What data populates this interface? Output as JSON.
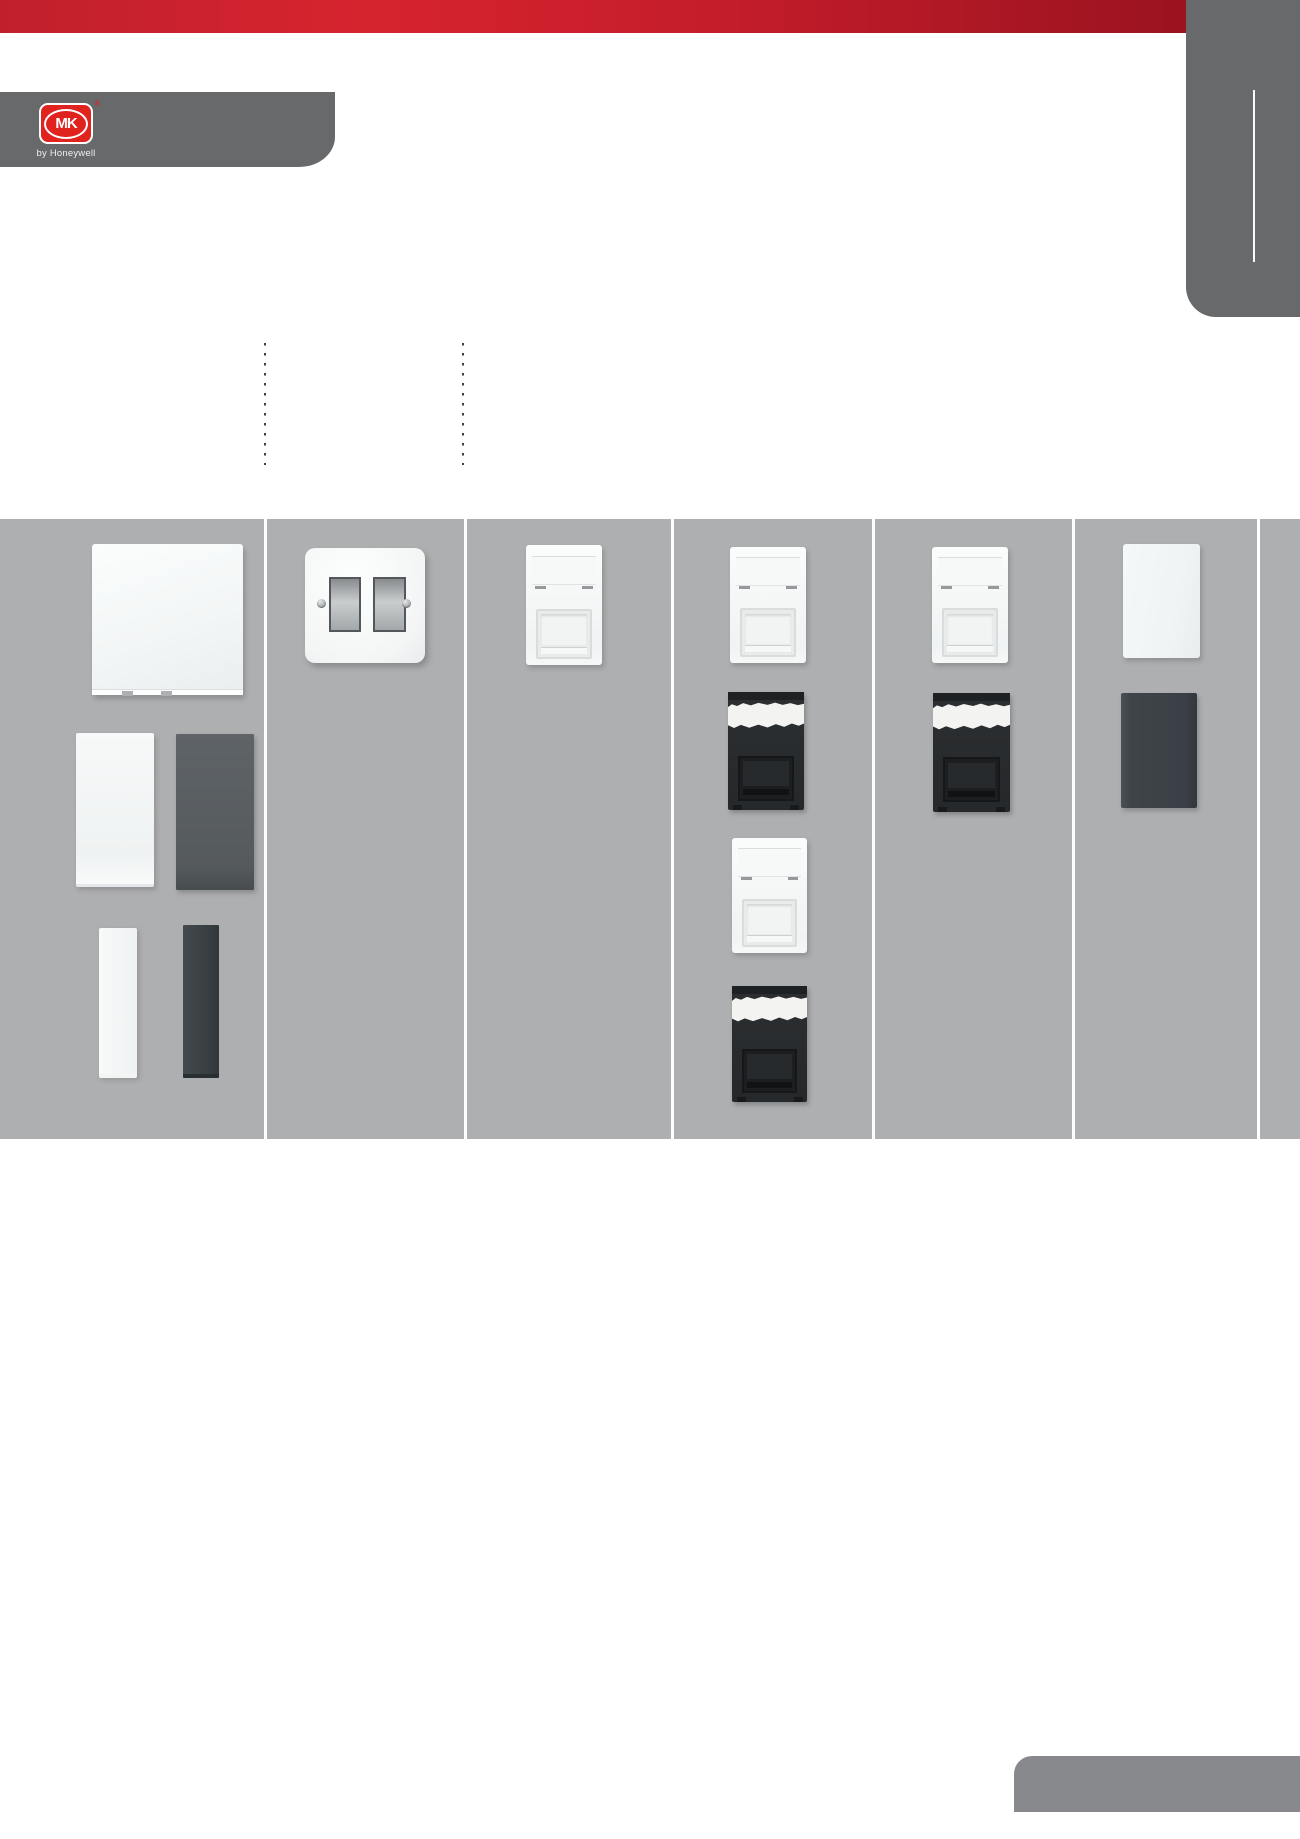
{
  "brand": {
    "logo_text": "MK",
    "registered": "®",
    "logo_sub": "by Honeywell"
  },
  "colors": {
    "banner_left": "#c0202c",
    "banner_mid": "#d6242f",
    "banner_mid2": "#c51d2a",
    "banner_right": "#9c1320",
    "brand_bar": "#67696b",
    "logo_red": "#e0231f",
    "top_tab": "#67696b",
    "bottom_tab": "#87898c",
    "band_bg": "#aeafb1",
    "separator": "#ffffff",
    "guide_dot": "#3f3f3f"
  },
  "grid": {
    "band_top": 519,
    "band_height": 620,
    "separators_x": [
      265,
      465,
      672,
      873,
      1073,
      1258
    ],
    "columns": 7
  },
  "guides": [
    {
      "x": 264,
      "top": 343,
      "height": 122
    },
    {
      "x": 462,
      "top": 343,
      "height": 122
    }
  ],
  "products": [
    {
      "name": "blanking-plate-white-large",
      "type": "blank-plate-large",
      "variant": "white",
      "x": 92,
      "y": 544,
      "w": 151,
      "h": 151
    },
    {
      "name": "euro-plate-white-tall",
      "type": "plate-tall",
      "variant": "white",
      "x": 76,
      "y": 733,
      "w": 78,
      "h": 154
    },
    {
      "name": "euro-plate-graphite-tall",
      "type": "plate-tall",
      "variant": "dark",
      "x": 176,
      "y": 734,
      "w": 78,
      "h": 156
    },
    {
      "name": "half-blank-strip-white",
      "type": "strip",
      "variant": "white",
      "x": 99,
      "y": 928,
      "w": 38,
      "h": 150
    },
    {
      "name": "half-blank-strip-graphite",
      "type": "strip",
      "variant": "dark",
      "x": 183,
      "y": 925,
      "w": 36,
      "h": 153
    },
    {
      "name": "grid-switch-2gang-white",
      "type": "grid-switch",
      "variant": "white",
      "x": 305,
      "y": 548,
      "w": 120,
      "h": 115
    },
    {
      "name": "data-module-white",
      "type": "module-white",
      "variant": "white",
      "x": 526,
      "y": 545,
      "w": 76,
      "h": 120
    },
    {
      "name": "data-module-white",
      "type": "module-white",
      "variant": "white",
      "x": 730,
      "y": 547,
      "w": 76,
      "h": 116
    },
    {
      "name": "data-module-black",
      "type": "module-dark",
      "variant": "dark",
      "x": 728,
      "y": 692,
      "w": 76,
      "h": 118
    },
    {
      "name": "data-module-white",
      "type": "module-white",
      "variant": "white",
      "x": 732,
      "y": 838,
      "w": 75,
      "h": 115
    },
    {
      "name": "data-module-black",
      "type": "module-dark",
      "variant": "dark",
      "x": 732,
      "y": 986,
      "w": 75,
      "h": 116
    },
    {
      "name": "data-module-white",
      "type": "module-white",
      "variant": "white",
      "x": 932,
      "y": 547,
      "w": 76,
      "h": 116
    },
    {
      "name": "data-module-black",
      "type": "module-dark",
      "variant": "dark",
      "x": 933,
      "y": 693,
      "w": 77,
      "h": 119
    },
    {
      "name": "blank-module-white",
      "type": "blank-module",
      "variant": "white",
      "x": 1123,
      "y": 544,
      "w": 77,
      "h": 114
    },
    {
      "name": "blank-module-graphite",
      "type": "blank-module",
      "variant": "dark",
      "x": 1121,
      "y": 693,
      "w": 76,
      "h": 115
    }
  ]
}
